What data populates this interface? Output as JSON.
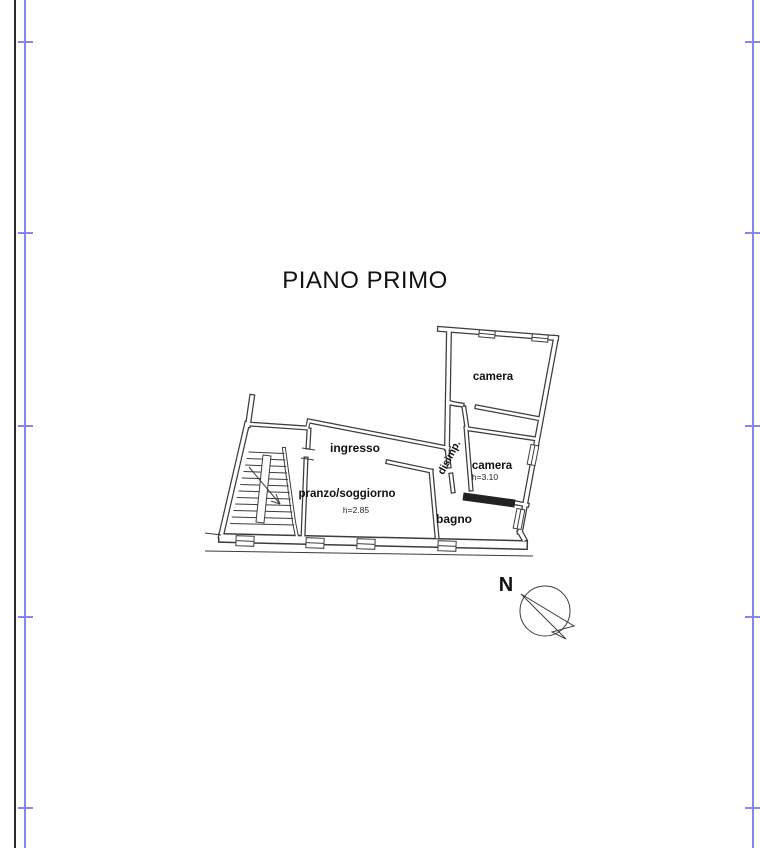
{
  "page": {
    "title": "PIANO PRIMO"
  },
  "plan": {
    "rooms": [
      {
        "id": "camera-top",
        "label": "camera"
      },
      {
        "id": "camera-lower",
        "label": "camera",
        "height_note": "h=3.10"
      },
      {
        "id": "disimpegno",
        "label": "disimp."
      },
      {
        "id": "ingresso",
        "label": "ingresso"
      },
      {
        "id": "pranzo-soggiorno",
        "label": "pranzo/soggiorno",
        "height_note": "h=2.85"
      },
      {
        "id": "bagno",
        "label": "bagno"
      }
    ],
    "compass": {
      "north_label": "N"
    }
  },
  "colors": {
    "border_blue": "#8686ec",
    "frame_black": "#2a2a2a",
    "drawing_line": "#3c3c3c",
    "background": "#ffffff"
  }
}
